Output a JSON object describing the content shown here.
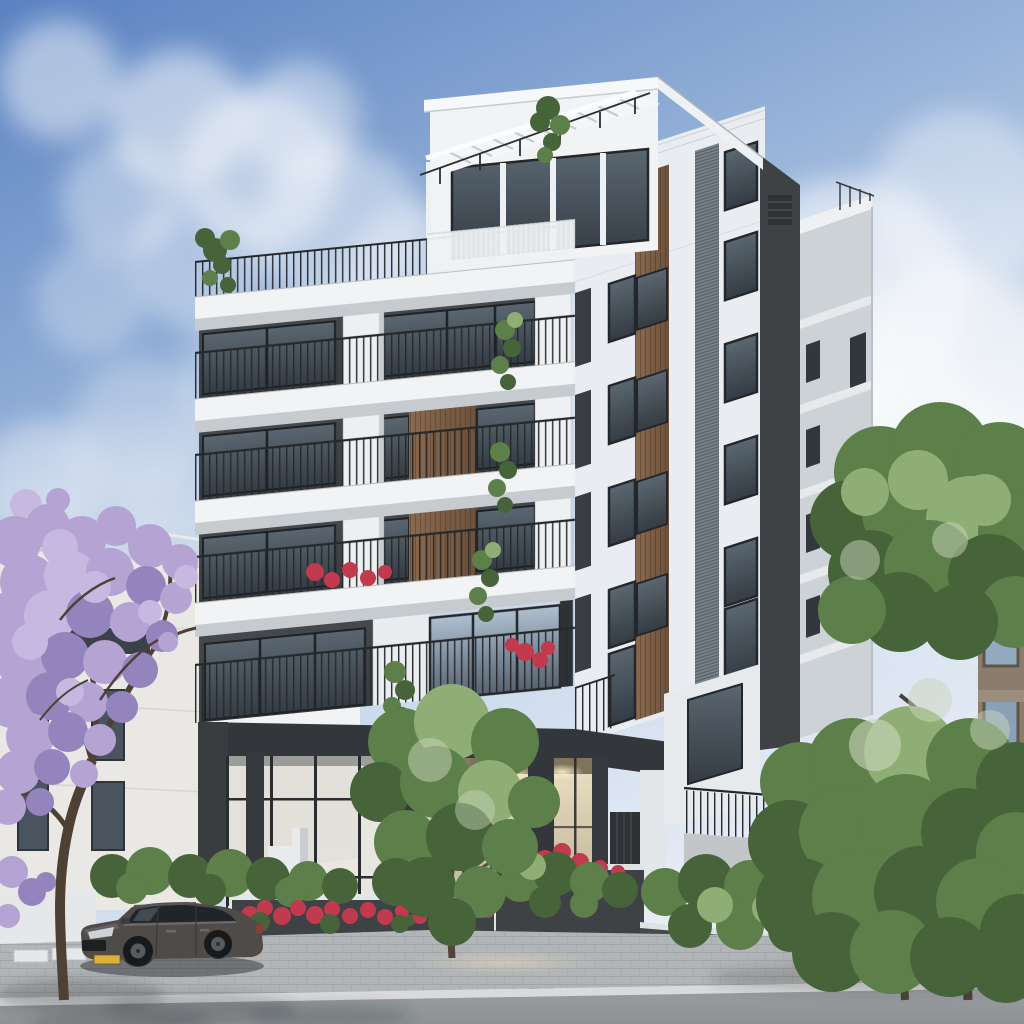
{
  "scene": {
    "type": "architectural-exterior-render",
    "subject": "modern-residential-apartment-building",
    "time_of_day": "day",
    "balcony_rows": 4,
    "has_penthouse": true,
    "has_roof_pergola": true,
    "entrance": "double-height warm-lit glass lobby with wall clock, sconces and lounge chairs",
    "vehicle": {
      "type": "suv",
      "body_color_key": "car_body",
      "plate_color_key": "plate_yellow"
    },
    "vegetation": {
      "jacaranda_tree": 1,
      "green_trees": 3,
      "hedges": true,
      "red_flowers": true
    }
  },
  "palette": {
    "sky_top": "#5b82c1",
    "sky_mid": "#8fadd6",
    "sky_low": "#c9d8ec",
    "sky_horizon": "#e8edf5",
    "cloud": "#f8fafc",
    "facade_white": "#f1f3f5",
    "facade_shade": "#e9edf1",
    "slab_underside": "#c6cbd0",
    "recess_dark": "#383b3f",
    "window_frame": "#23262a",
    "glass_light": "#aebfd0",
    "glass_dark": "#57636e",
    "glass_deep": "#343c44",
    "wood_light": "#8a6a4e",
    "wood_dark": "#6e523c",
    "louver_gray": "#7a838c",
    "core_dark": "#3e4245",
    "rear_wing_gray": "#cdd2d7",
    "beam_dark": "#33363a",
    "column_dark": "#36393d",
    "entrance_glow": "#efe3c2",
    "entrance_beige": "#cdbf9f",
    "entrance_deep": "#a79878",
    "railing_dark": "#26292c",
    "foliage_light": "#8fae76",
    "foliage_mid": "#5d7f4a",
    "foliage_dark": "#46633a",
    "foliage_speckle": "#c9d6bb",
    "jacaranda_light": "#c6b8e0",
    "jacaranda_mid": "#b4a3d3",
    "jacaranda_shade": "#9484bd",
    "branch_brown": "#4e4033",
    "flower_red": "#c23a4e",
    "planter_gray": "#3f4244",
    "wall_white": "#e8eaec",
    "sidewalk_gray": "#b2b5b7",
    "curb_light": "#d8dadb",
    "road_gray": "#8d9194",
    "car_body": "#4e4b49",
    "car_glass": "#21252a",
    "plate_yellow": "#d9b13b",
    "neighbor_white": "#e9e8e4",
    "old_building_tan": "#8b7d6d",
    "frosted_glass": "#e8e6df"
  },
  "blobs": {
    "clouds": [
      [
        60,
        80,
        60,
        "cloud",
        0.5
      ],
      [
        180,
        120,
        70,
        "cloud",
        0.55
      ],
      [
        260,
        170,
        80,
        "cloud",
        0.5
      ],
      [
        340,
        230,
        85,
        "cloud",
        0.45
      ],
      [
        420,
        285,
        80,
        "cloud",
        0.4
      ],
      [
        120,
        200,
        60,
        "cloud",
        0.4
      ],
      [
        200,
        260,
        70,
        "cloud",
        0.38
      ],
      [
        90,
        300,
        55,
        "cloud",
        0.3
      ],
      [
        300,
        120,
        60,
        "cloud",
        0.45
      ],
      [
        500,
        330,
        90,
        "cloud",
        0.35
      ],
      [
        600,
        380,
        100,
        "cloud",
        0.4
      ],
      [
        720,
        340,
        110,
        "cloud",
        0.5
      ],
      [
        850,
        300,
        120,
        "cloud",
        0.55
      ],
      [
        950,
        380,
        110,
        "cloud",
        0.6
      ],
      [
        880,
        460,
        120,
        "cloud",
        0.5
      ],
      [
        780,
        440,
        100,
        "cloud",
        0.45
      ],
      [
        140,
        430,
        70,
        "cloud",
        0.3
      ],
      [
        40,
        480,
        60,
        "cloud",
        0.35
      ],
      [
        240,
        380,
        60,
        "cloud",
        0.28
      ],
      [
        960,
        200,
        90,
        "cloud",
        0.4
      ],
      [
        1000,
        500,
        100,
        "cloud",
        0.5
      ],
      [
        660,
        250,
        80,
        "cloud",
        0.35
      ]
    ],
    "jacaranda": [
      [
        26,
        505,
        16,
        "jacaranda_light"
      ],
      [
        58,
        500,
        12,
        "jacaranda_mid"
      ],
      [
        15,
        542,
        26,
        "jacaranda_mid"
      ],
      [
        48,
        526,
        22,
        "jacaranda_mid"
      ],
      [
        82,
        540,
        24,
        "jacaranda_mid"
      ],
      [
        116,
        526,
        20,
        "jacaranda_mid"
      ],
      [
        150,
        546,
        22,
        "jacaranda_mid"
      ],
      [
        180,
        562,
        18,
        "jacaranda_mid"
      ],
      [
        28,
        582,
        28,
        "jacaranda_mid"
      ],
      [
        70,
        576,
        26,
        "jacaranda_light"
      ],
      [
        110,
        572,
        24,
        "jacaranda_mid"
      ],
      [
        146,
        586,
        20,
        "jacaranda_shade"
      ],
      [
        176,
        598,
        16,
        "jacaranda_mid"
      ],
      [
        10,
        622,
        30,
        "jacaranda_mid"
      ],
      [
        50,
        616,
        26,
        "jacaranda_light"
      ],
      [
        90,
        614,
        24,
        "jacaranda_shade"
      ],
      [
        130,
        622,
        20,
        "jacaranda_mid"
      ],
      [
        162,
        636,
        16,
        "jacaranda_shade"
      ],
      [
        25,
        662,
        28,
        "jacaranda_mid"
      ],
      [
        65,
        656,
        24,
        "jacaranda_shade"
      ],
      [
        105,
        662,
        22,
        "jacaranda_mid"
      ],
      [
        140,
        670,
        18,
        "jacaranda_shade"
      ],
      [
        12,
        702,
        26,
        "jacaranda_mid"
      ],
      [
        50,
        696,
        24,
        "jacaranda_shade"
      ],
      [
        88,
        702,
        20,
        "jacaranda_mid"
      ],
      [
        122,
        707,
        16,
        "jacaranda_shade"
      ],
      [
        30,
        737,
        24,
        "jacaranda_mid"
      ],
      [
        68,
        732,
        20,
        "jacaranda_shade"
      ],
      [
        100,
        740,
        16,
        "jacaranda_mid"
      ],
      [
        18,
        772,
        22,
        "jacaranda_mid"
      ],
      [
        52,
        767,
        18,
        "jacaranda_shade"
      ],
      [
        84,
        774,
        14,
        "jacaranda_mid"
      ],
      [
        8,
        807,
        18,
        "jacaranda_mid"
      ],
      [
        40,
        802,
        14,
        "jacaranda_shade"
      ],
      [
        150,
        612,
        12,
        "jacaranda_light"
      ],
      [
        168,
        642,
        10,
        "jacaranda_mid"
      ],
      [
        186,
        577,
        12,
        "jacaranda_light"
      ],
      [
        60,
        547,
        18,
        "jacaranda_light"
      ],
      [
        95,
        587,
        16,
        "jacaranda_light"
      ],
      [
        30,
        642,
        18,
        "jacaranda_light"
      ],
      [
        70,
        692,
        14,
        "jacaranda_light"
      ],
      [
        12,
        872,
        16,
        "jacaranda_mid"
      ],
      [
        32,
        892,
        14,
        "jacaranda_shade"
      ],
      [
        8,
        916,
        12,
        "jacaranda_mid"
      ],
      [
        46,
        882,
        10,
        "jacaranda_shade"
      ]
    ],
    "right_trees": [
      [
        880,
        472,
        46,
        "foliage_mid"
      ],
      [
        940,
        452,
        50,
        "foliage_mid"
      ],
      [
        1000,
        470,
        48,
        "foliage_mid"
      ],
      [
        850,
        520,
        40,
        "foliage_dark"
      ],
      [
        910,
        512,
        48,
        "foliage_mid"
      ],
      [
        970,
        520,
        44,
        "foliage_light"
      ],
      [
        1018,
        532,
        40,
        "foliage_mid"
      ],
      [
        870,
        572,
        42,
        "foliage_dark"
      ],
      [
        930,
        566,
        46,
        "foliage_mid"
      ],
      [
        990,
        576,
        42,
        "foliage_dark"
      ],
      [
        1015,
        612,
        36,
        "foliage_mid"
      ],
      [
        900,
        612,
        40,
        "foliage_dark"
      ],
      [
        852,
        610,
        34,
        "foliage_mid"
      ],
      [
        960,
        622,
        38,
        "foliage_dark"
      ],
      [
        918,
        480,
        30,
        "foliage_light"
      ],
      [
        985,
        500,
        26,
        "foliage_light"
      ],
      [
        865,
        492,
        24,
        "foliage_light"
      ],
      [
        800,
        782,
        40,
        "foliage_mid"
      ],
      [
        852,
        762,
        44,
        "foliage_mid"
      ],
      [
        910,
        752,
        46,
        "foliage_light"
      ],
      [
        970,
        762,
        44,
        "foliage_mid"
      ],
      [
        1016,
        782,
        40,
        "foliage_dark"
      ],
      [
        790,
        842,
        42,
        "foliage_dark"
      ],
      [
        845,
        832,
        46,
        "foliage_mid"
      ],
      [
        905,
        822,
        48,
        "foliage_mid"
      ],
      [
        965,
        832,
        44,
        "foliage_dark"
      ],
      [
        1016,
        852,
        40,
        "foliage_mid"
      ],
      [
        800,
        902,
        44,
        "foliage_dark"
      ],
      [
        860,
        897,
        48,
        "foliage_mid"
      ],
      [
        920,
        892,
        46,
        "foliage_dark"
      ],
      [
        980,
        902,
        44,
        "foliage_mid"
      ],
      [
        1018,
        932,
        38,
        "foliage_dark"
      ],
      [
        832,
        952,
        40,
        "foliage_dark"
      ],
      [
        892,
        952,
        42,
        "foliage_mid"
      ],
      [
        950,
        957,
        40,
        "foliage_dark"
      ],
      [
        1006,
        967,
        36,
        "foliage_dark"
      ],
      [
        875,
        745,
        26,
        "foliage_speckle",
        0.6
      ],
      [
        930,
        700,
        22,
        "foliage_speckle",
        0.5
      ],
      [
        990,
        730,
        20,
        "foliage_speckle",
        0.5
      ],
      [
        860,
        560,
        20,
        "foliage_speckle",
        0.5
      ],
      [
        950,
        540,
        18,
        "foliage_speckle",
        0.5
      ]
    ],
    "middle_tree": [
      [
        402,
        742,
        34,
        "foliage_mid"
      ],
      [
        452,
        722,
        38,
        "foliage_light"
      ],
      [
        505,
        742,
        34,
        "foliage_mid"
      ],
      [
        380,
        792,
        30,
        "foliage_dark"
      ],
      [
        436,
        782,
        36,
        "foliage_mid"
      ],
      [
        490,
        792,
        32,
        "foliage_light"
      ],
      [
        534,
        802,
        26,
        "foliage_mid"
      ],
      [
        406,
        842,
        32,
        "foliage_mid"
      ],
      [
        460,
        837,
        34,
        "foliage_dark"
      ],
      [
        510,
        847,
        28,
        "foliage_mid"
      ],
      [
        426,
        887,
        30,
        "foliage_dark"
      ],
      [
        480,
        892,
        26,
        "foliage_mid"
      ],
      [
        396,
        882,
        24,
        "foliage_dark"
      ],
      [
        452,
        922,
        24,
        "foliage_dark"
      ],
      [
        430,
        760,
        22,
        "foliage_speckle",
        0.5
      ],
      [
        475,
        810,
        20,
        "foliage_speckle",
        0.45
      ]
    ],
    "hedge_left": [
      [
        112,
        876,
        22,
        "foliage_dark"
      ],
      [
        150,
        871,
        24,
        "foliage_mid"
      ],
      [
        190,
        876,
        22,
        "foliage_dark"
      ],
      [
        230,
        873,
        24,
        "foliage_mid"
      ],
      [
        268,
        879,
        22,
        "foliage_dark"
      ],
      [
        308,
        881,
        20,
        "foliage_mid"
      ],
      [
        340,
        886,
        18,
        "foliage_dark"
      ],
      [
        132,
        888,
        16,
        "foliage_mid"
      ],
      [
        210,
        890,
        16,
        "foliage_dark"
      ],
      [
        290,
        892,
        15,
        "foliage_mid"
      ]
    ],
    "right_bushes": [
      [
        665,
        892,
        24,
        "foliage_mid"
      ],
      [
        706,
        882,
        28,
        "foliage_dark"
      ],
      [
        750,
        886,
        26,
        "foliage_mid"
      ],
      [
        794,
        892,
        26,
        "foliage_dark"
      ],
      [
        836,
        896,
        24,
        "foliage_mid"
      ],
      [
        872,
        902,
        22,
        "foliage_dark"
      ],
      [
        690,
        926,
        22,
        "foliage_dark"
      ],
      [
        740,
        926,
        24,
        "foliage_mid"
      ],
      [
        790,
        930,
        22,
        "foliage_dark"
      ],
      [
        838,
        932,
        20,
        "foliage_mid"
      ],
      [
        876,
        936,
        18,
        "foliage_dark"
      ],
      [
        715,
        905,
        18,
        "foliage_light"
      ],
      [
        768,
        908,
        16,
        "foliage_light"
      ]
    ],
    "entrance_bushes": [
      [
        520,
        882,
        20,
        "foliage_mid"
      ],
      [
        556,
        874,
        22,
        "foliage_dark"
      ],
      [
        590,
        882,
        20,
        "foliage_mid"
      ],
      [
        620,
        890,
        18,
        "foliage_dark"
      ],
      [
        545,
        902,
        16,
        "foliage_dark"
      ],
      [
        584,
        904,
        14,
        "foliage_mid"
      ],
      [
        532,
        866,
        14,
        "foliage_light"
      ]
    ],
    "flower_beds": [
      [
        250,
        915,
        9,
        "flower_red"
      ],
      [
        265,
        908,
        8,
        "flower_red"
      ],
      [
        282,
        916,
        9,
        "flower_red"
      ],
      [
        298,
        908,
        8,
        "flower_red"
      ],
      [
        315,
        915,
        9,
        "flower_red"
      ],
      [
        332,
        909,
        8,
        "flower_red"
      ],
      [
        350,
        916,
        8,
        "flower_red"
      ],
      [
        368,
        910,
        8,
        "flower_red"
      ],
      [
        385,
        917,
        8,
        "flower_red"
      ],
      [
        402,
        911,
        7,
        "flower_red"
      ],
      [
        420,
        917,
        7,
        "flower_red"
      ],
      [
        448,
        913,
        7,
        "flower_red"
      ],
      [
        470,
        916,
        6,
        "flower_red"
      ],
      [
        488,
        912,
        6,
        "flower_red"
      ],
      [
        260,
        922,
        10,
        "foliage_dark"
      ],
      [
        330,
        924,
        10,
        "foliage_dark"
      ],
      [
        400,
        924,
        9,
        "foliage_dark"
      ],
      [
        455,
        922,
        9,
        "foliage_dark"
      ],
      [
        510,
        862,
        10,
        "flower_red"
      ],
      [
        528,
        852,
        9,
        "flower_red"
      ],
      [
        545,
        860,
        10,
        "flower_red"
      ],
      [
        562,
        852,
        9,
        "flower_red"
      ],
      [
        580,
        862,
        9,
        "flower_red"
      ],
      [
        600,
        868,
        8,
        "flower_red"
      ],
      [
        618,
        872,
        7,
        "flower_red"
      ]
    ],
    "balcony_flowers": [
      [
        315,
        572,
        9,
        "flower_red"
      ],
      [
        332,
        580,
        8,
        "flower_red"
      ],
      [
        350,
        570,
        8,
        "flower_red"
      ],
      [
        368,
        578,
        8,
        "flower_red"
      ],
      [
        385,
        572,
        7,
        "flower_red"
      ],
      [
        525,
        652,
        9,
        "flower_red"
      ],
      [
        540,
        660,
        8,
        "flower_red"
      ],
      [
        512,
        645,
        7,
        "flower_red"
      ],
      [
        548,
        648,
        7,
        "flower_red"
      ]
    ],
    "balcony_plants": [
      [
        505,
        330,
        10,
        "foliage_mid"
      ],
      [
        512,
        348,
        9,
        "foliage_dark"
      ],
      [
        500,
        365,
        9,
        "foliage_mid"
      ],
      [
        508,
        382,
        8,
        "foliage_dark"
      ],
      [
        515,
        320,
        8,
        "foliage_light"
      ],
      [
        500,
        452,
        10,
        "foliage_mid"
      ],
      [
        508,
        470,
        9,
        "foliage_dark"
      ],
      [
        497,
        488,
        9,
        "foliage_mid"
      ],
      [
        505,
        505,
        8,
        "foliage_dark"
      ],
      [
        482,
        560,
        10,
        "foliage_mid"
      ],
      [
        490,
        578,
        9,
        "foliage_dark"
      ],
      [
        478,
        596,
        9,
        "foliage_mid"
      ],
      [
        486,
        614,
        8,
        "foliage_dark"
      ],
      [
        493,
        550,
        8,
        "foliage_light"
      ],
      [
        395,
        672,
        11,
        "foliage_mid"
      ],
      [
        405,
        690,
        10,
        "foliage_dark"
      ],
      [
        392,
        706,
        9,
        "foliage_mid"
      ],
      [
        402,
        715,
        8,
        "foliage_dark"
      ],
      [
        215,
        250,
        12,
        "foliage_dark"
      ],
      [
        230,
        240,
        10,
        "foliage_mid"
      ],
      [
        205,
        238,
        10,
        "foliage_dark"
      ],
      [
        222,
        265,
        9,
        "foliage_dark"
      ],
      [
        210,
        278,
        8,
        "foliage_mid"
      ],
      [
        228,
        285,
        8,
        "foliage_dark"
      ],
      [
        548,
        108,
        12,
        "foliage_dark"
      ],
      [
        560,
        125,
        10,
        "foliage_mid"
      ],
      [
        540,
        122,
        10,
        "foliage_dark"
      ],
      [
        552,
        142,
        9,
        "foliage_dark"
      ],
      [
        545,
        155,
        8,
        "foliage_mid"
      ],
      [
        415,
        895,
        8,
        "foliage_mid"
      ],
      [
        422,
        910,
        7,
        "foliage_dark"
      ],
      [
        410,
        920,
        6,
        "foliage_dark"
      ]
    ]
  }
}
